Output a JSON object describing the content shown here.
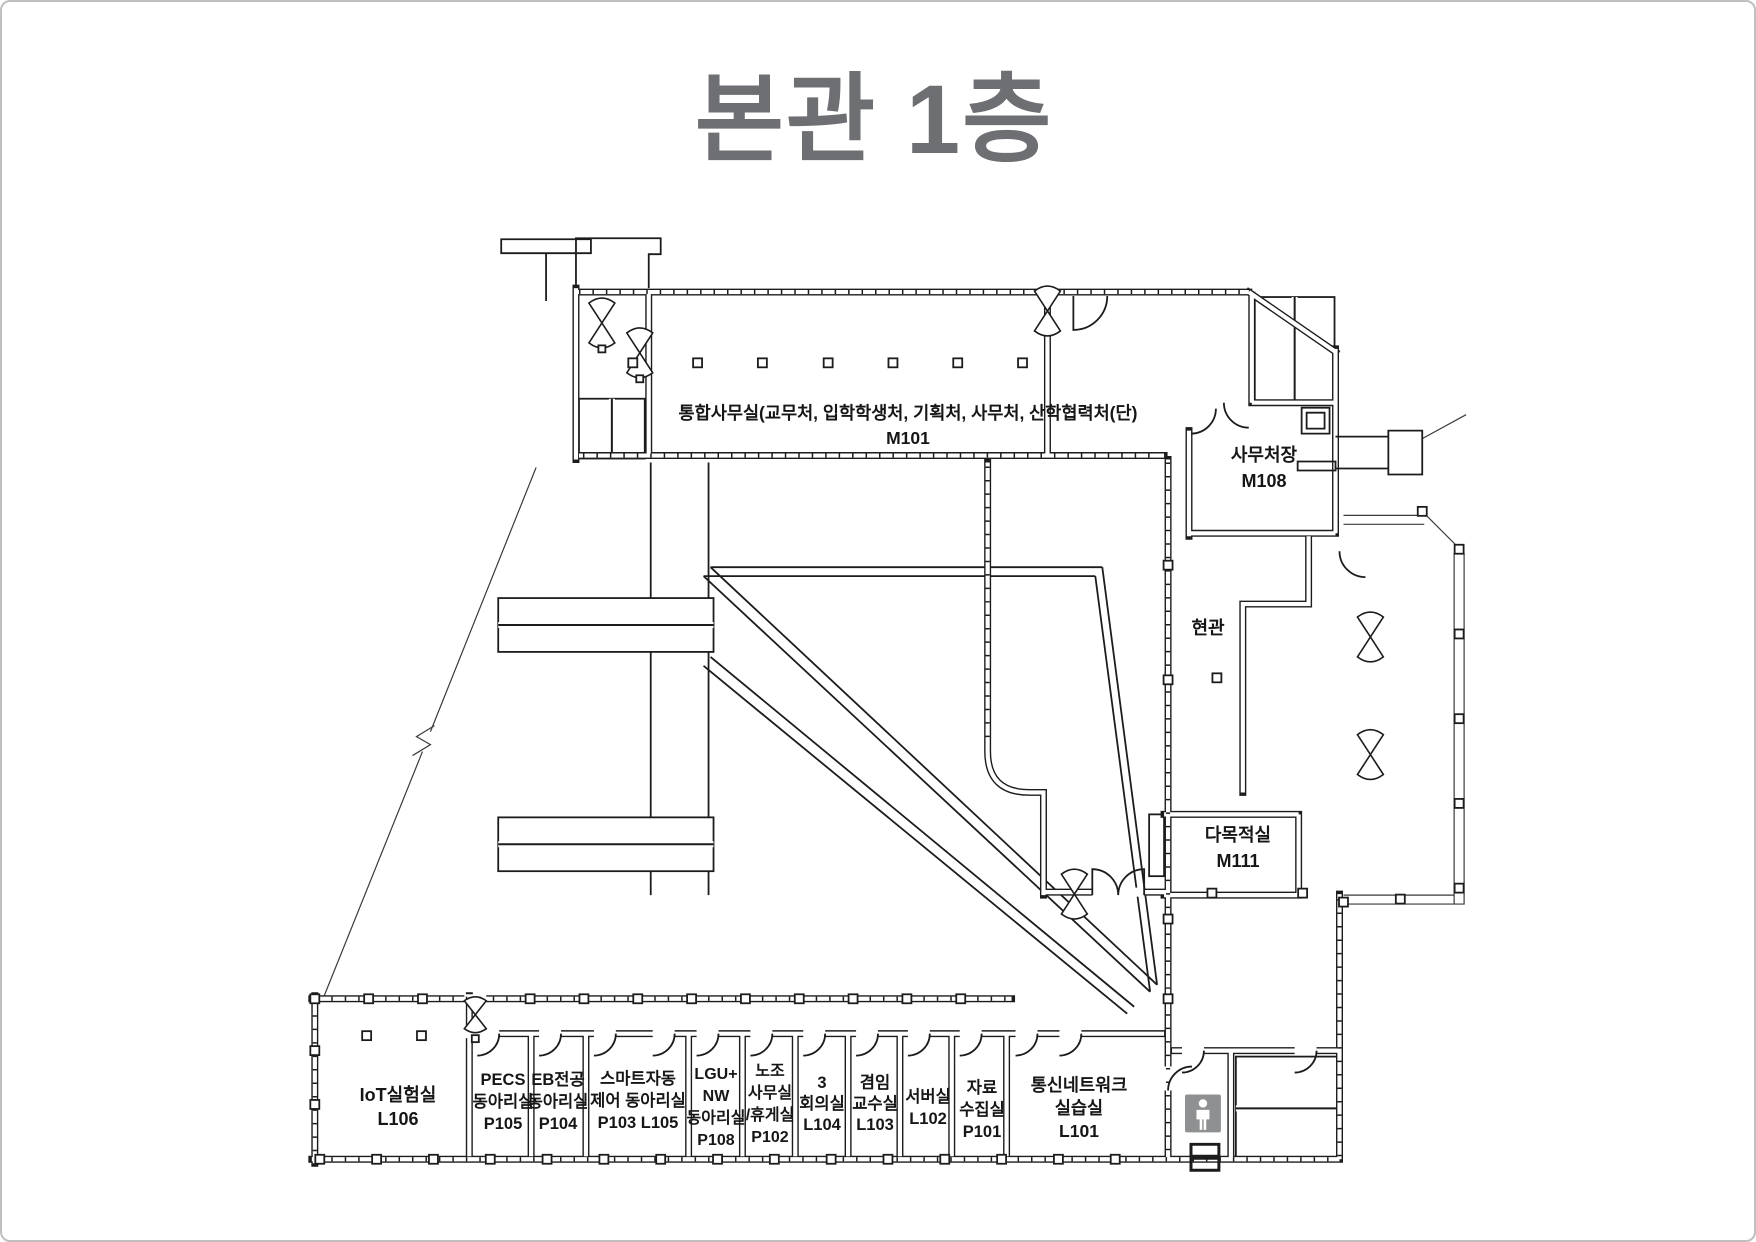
{
  "title": "본관 1층",
  "rooms": {
    "m101": {
      "lines": [
        "통합사무실(교무처, 입학학생처, 기획처, 사무처, 산학협력처(단)",
        "M101"
      ]
    },
    "m108": {
      "lines": [
        "사무처장",
        "M108"
      ]
    },
    "lobby": {
      "lines": [
        "현관"
      ]
    },
    "m111": {
      "lines": [
        "다목적실",
        "M111"
      ]
    },
    "l106": {
      "lines": [
        "IoT실험실",
        "L106"
      ]
    },
    "p105": {
      "lines": [
        "PECS",
        "동아리실",
        "P105"
      ]
    },
    "p104": {
      "lines": [
        "EB전공",
        "동아리실",
        "P104"
      ]
    },
    "p103": {
      "lines": [
        "스마트자동",
        "제어 동아리실",
        "P103 L105"
      ]
    },
    "p108": {
      "lines": [
        "LGU+",
        "NW",
        "동아리실",
        "P108"
      ]
    },
    "p102": {
      "lines": [
        "노조",
        "사무실",
        "/휴게실",
        "P102"
      ]
    },
    "l104": {
      "lines": [
        "3",
        "회의실",
        "L104"
      ]
    },
    "l103": {
      "lines": [
        "겸임",
        "교수실",
        "L103"
      ]
    },
    "l102": {
      "lines": [
        "서버실",
        "L102"
      ]
    },
    "p101": {
      "lines": [
        "자료",
        "수집실",
        "P101"
      ]
    },
    "l101": {
      "lines": [
        "통신네트워크",
        "실습실",
        "L101"
      ]
    }
  },
  "icons": {
    "restroom": "male-restroom-icon"
  },
  "colors": {
    "title": "#6e6f72",
    "line": "#1c1c1c",
    "restroom_bg": "#8f9091"
  }
}
